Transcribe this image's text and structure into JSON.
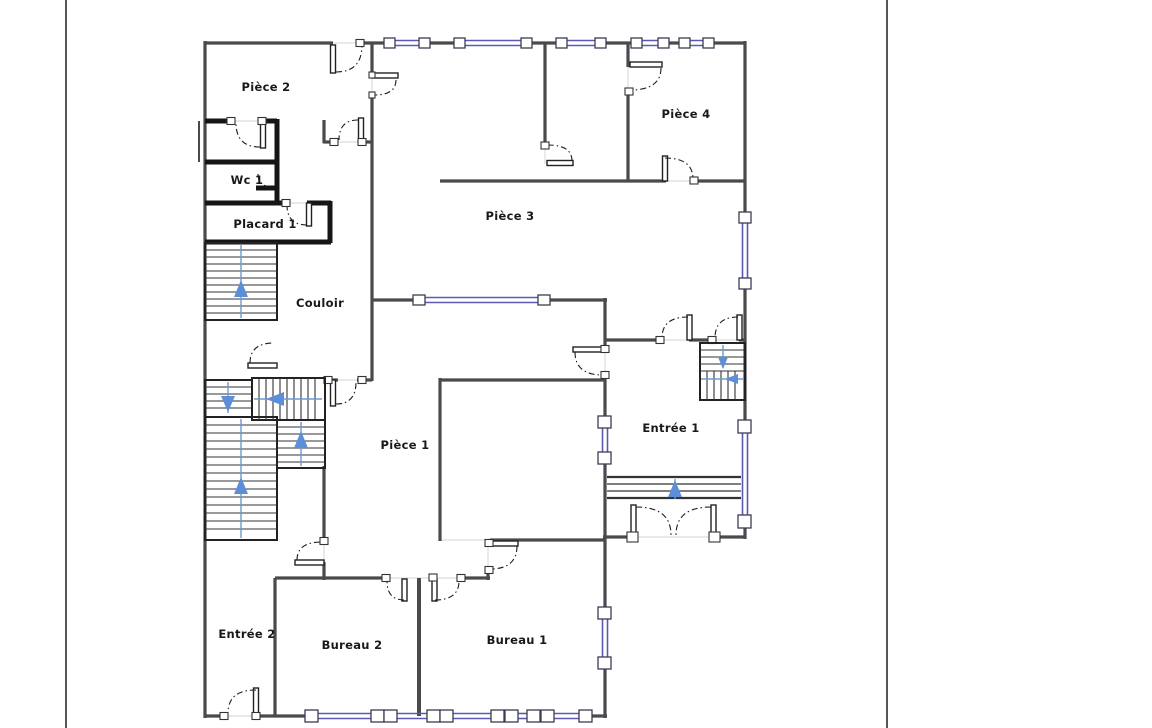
{
  "plan": {
    "title": "floor-plan",
    "rooms": [
      {
        "id": "piece-2",
        "label": "Pièce 2"
      },
      {
        "id": "wc-1",
        "label": "Wc 1"
      },
      {
        "id": "placard-1",
        "label": "Placard 1"
      },
      {
        "id": "couloir",
        "label": "Couloir"
      },
      {
        "id": "piece-3",
        "label": "Pièce 3"
      },
      {
        "id": "piece-4",
        "label": "Pièce 4"
      },
      {
        "id": "piece-1",
        "label": "Pièce 1"
      },
      {
        "id": "entree-1",
        "label": "Entrée 1"
      },
      {
        "id": "entree-2",
        "label": "Entrée 2"
      },
      {
        "id": "bureau-2",
        "label": "Bureau 2"
      },
      {
        "id": "bureau-1",
        "label": "Bureau 1"
      }
    ],
    "colors": {
      "wall": "#4a4a4d",
      "partition": "#161616",
      "window": "#5a5ab5",
      "stair_accent": "#5d8ed8",
      "door_arc": "#1c1c1c",
      "page_edge": "#56565a",
      "label_text": "#191919"
    }
  }
}
